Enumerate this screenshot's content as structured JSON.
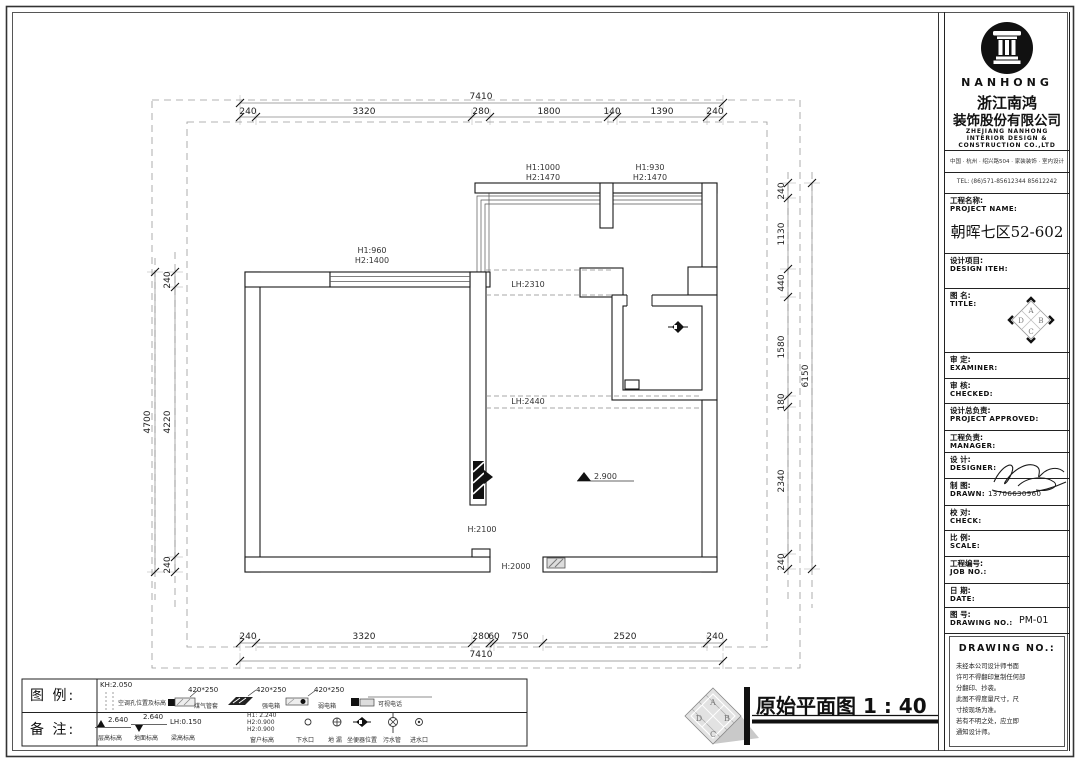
{
  "plan": {
    "dims": {
      "top_total": "7410",
      "top": [
        "240",
        "3320",
        "280",
        "1800",
        "140",
        "1390",
        "240"
      ],
      "bottom": [
        "240",
        "3320",
        "280",
        "60",
        "750",
        "2520",
        "240"
      ],
      "bottom_total": "7410",
      "left": [
        "240",
        "4220",
        "240"
      ],
      "left_total": "4700",
      "right": [
        "240",
        "1130",
        "440",
        "1580",
        "180",
        "2340",
        "240"
      ],
      "right_total": "6150"
    },
    "windows": [
      {
        "line1": "H1:960",
        "line2": "H2:1400"
      },
      {
        "line1": "H1:1000",
        "line2": "H2:1470"
      },
      {
        "line1": "H1:930",
        "line2": "H2:1470"
      }
    ],
    "beams": [
      "LH:2310",
      "LH:2440"
    ],
    "openings": [
      "H:2100",
      "H:2000"
    ],
    "floor_elevation": "2.900",
    "title": "原始平面图",
    "scale": "1 : 40"
  },
  "legend": {
    "row1_label": "图 例:",
    "row2_label": "备 注:",
    "aircon": {
      "value": "KH:2.050",
      "name": "空调孔位置及标高"
    },
    "gas": {
      "value": "420*250",
      "name": "煤气管套"
    },
    "power_box": {
      "value": "420*250",
      "name": "强电箱"
    },
    "weak_box": {
      "value": "420*250",
      "name": "弱电箱"
    },
    "videophone": {
      "name": "可视电话"
    },
    "floor_h": {
      "value": "2.640",
      "name": "层高标高"
    },
    "ground_h": {
      "value": "2.640",
      "name": "地面标高"
    },
    "beam_h": {
      "value": "LH:0.150",
      "name": "梁高标高"
    },
    "window_h": {
      "l1": "H1: 2.240",
      "l2": "H2:0.900",
      "l3": "H2:0.900",
      "name": "窗户标高"
    },
    "drain": {
      "name": "下水口"
    },
    "floor_drain": {
      "name": "地 漏"
    },
    "toilet": {
      "name": "坐便器位置"
    },
    "sewage": {
      "name": "污水管"
    },
    "inlet": {
      "name": "进水口"
    }
  },
  "titleblock": {
    "brand": "NANHONG",
    "company_cn1": "浙江南鸿",
    "company_cn2": "装饰股份有限公司",
    "company_en1": "ZHEJIANG NANHONG",
    "company_en2": "INTERIOR DESIGN &",
    "company_en3": "CONSTRUCTION CO.,LTD",
    "address": "中国 · 杭州 · 绍兴路504 · 家装装饰 · 室内设计",
    "tel": "TEL: (86)571-85612344  85612242",
    "project": {
      "cn": "工程名称:",
      "en": "PROJECT NAME:",
      "value": "朝晖七区52-602"
    },
    "rows": [
      {
        "cn": "设计项目:",
        "en": "DESIGN ITEH:",
        "value": ""
      },
      {
        "cn": "图  名:",
        "en": "TITLE:",
        "value": ""
      },
      {
        "cn": "审  定:",
        "en": "EXAMINER:",
        "value": ""
      },
      {
        "cn": "审  核:",
        "en": "CHECKED:",
        "value": ""
      },
      {
        "cn": "设计总负责:",
        "en": "PROJECT APPROVED:",
        "value": ""
      },
      {
        "cn": "工程负责:",
        "en": "MANAGER:",
        "value": ""
      },
      {
        "cn": "设  计:",
        "en": "DESIGNER:",
        "value": ""
      },
      {
        "cn": "制  图:",
        "en": "DRAWN:",
        "value": "13706630960"
      },
      {
        "cn": "校  对:",
        "en": "CHECK:",
        "value": ""
      },
      {
        "cn": "比  例:",
        "en": "SCALE:",
        "value": ""
      },
      {
        "cn": "工程编号:",
        "en": "JOB NO.:",
        "value": ""
      },
      {
        "cn": "日  期:",
        "en": "DATE:",
        "value": ""
      },
      {
        "cn": "图  号:",
        "en": "DRAWING NO.:",
        "value": "PM-01"
      }
    ],
    "drawing_no_heading": "DRAWING NO.:",
    "notes": [
      "未经本公司设计师书面",
      "许可不得翻印复制任何部",
      "分翻印、抄袭。",
      "此图不得度量尺寸，尺",
      "寸按现场为准。",
      "若有不明之处，应立即",
      "通知设计师。"
    ]
  }
}
